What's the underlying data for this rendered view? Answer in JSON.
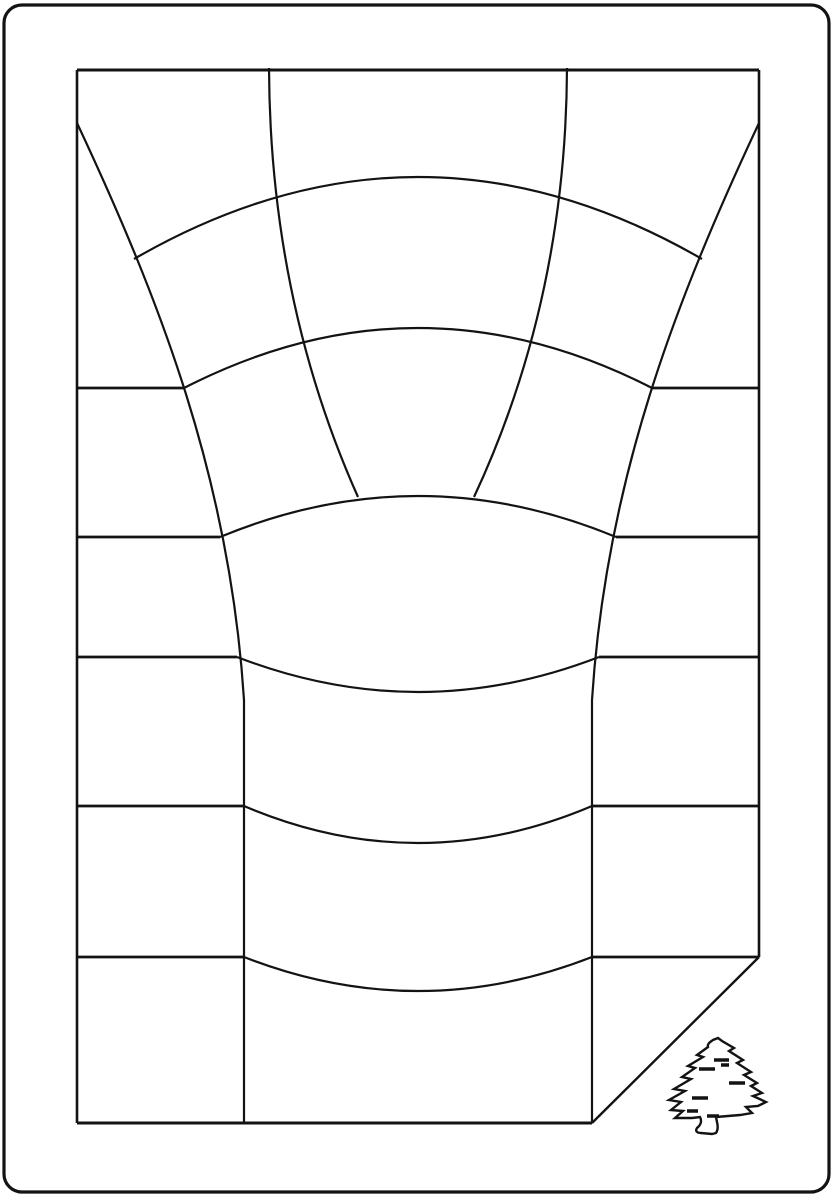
{
  "canvas": {
    "width": 834,
    "height": 1200,
    "background_color": "#ffffff"
  },
  "drawing": {
    "stroke_color": "#131313",
    "default_stroke_width": 2.2,
    "elements": [
      {
        "name": "outer-border",
        "type": "rect",
        "x": 4,
        "y": 5,
        "width": 825,
        "height": 1187,
        "radius": 18,
        "stroke_width": 3.2
      },
      {
        "name": "sheet-top-edge",
        "d": "M77,70 H759",
        "stroke_width": 3
      },
      {
        "name": "sheet-left-edge",
        "d": "M77,70 V1123",
        "stroke_width": 2.6
      },
      {
        "name": "sheet-right-edge",
        "d": "M759,70 V957",
        "stroke_width": 2.6
      },
      {
        "name": "sheet-bottom-edge",
        "d": "M77,1123 H592",
        "stroke_width": 3
      },
      {
        "name": "folded-corner-diagonal",
        "d": "M759,957 L592,1123",
        "stroke_width": 2.4
      },
      {
        "name": "warp-line-left-outer",
        "d": "M77,123 C160,300 230,480 244,700 L244,1123",
        "stroke_width": 2.2
      },
      {
        "name": "warp-line-right-outer",
        "d": "M759,123 C676,300 606,480 592,700 L592,1123",
        "stroke_width": 2.2
      },
      {
        "name": "warp-line-left-inner",
        "d": "M269,68 Q270,300 358,497",
        "stroke_width": 2.2
      },
      {
        "name": "warp-line-right-inner",
        "d": "M567,68 Q566,300 474,497",
        "stroke_width": 2.2
      },
      {
        "name": "ring-arc-1",
        "d": "M134,259 Q418,95 702,259",
        "stroke_width": 2.2
      },
      {
        "name": "ring-arc-2",
        "d": "M184,388 Q418,268 652,388",
        "stroke_width": 2.2
      },
      {
        "name": "ring-arc-3",
        "d": "M220,537 Q418,455 616,537",
        "stroke_width": 2.2
      },
      {
        "name": "ring-arc-4",
        "d": "M237,657 Q418,727 599,657",
        "stroke_width": 2.2
      },
      {
        "name": "ring-arc-5",
        "d": "M244,806 Q418,880 592,806",
        "stroke_width": 2.2
      },
      {
        "name": "ring-arc-6",
        "d": "M244,957 Q418,1025 592,957",
        "stroke_width": 2.2
      },
      {
        "name": "row-line-1",
        "d": "M77,388 H184 M652,388 H759",
        "stroke_width": 2.8
      },
      {
        "name": "row-line-2",
        "d": "M77,537 H220 M616,537 H759",
        "stroke_width": 2.8
      },
      {
        "name": "row-line-3",
        "d": "M77,657 H237 M599,657 H759",
        "stroke_width": 2.8
      },
      {
        "name": "row-line-4",
        "d": "M77,806 H244 M592,806 H759",
        "stroke_width": 2.8
      },
      {
        "name": "row-line-5",
        "d": "M77,957 H244 M592,957 H759",
        "stroke_width": 2.8
      },
      {
        "name": "pine-tree-icon",
        "d": "M713,1040 C710,1042 707,1044 708,1047 L697,1055 L703,1057 L688,1066 L695,1068 L682,1077 L691,1079 L674,1089 L685,1091 L669,1100 L681,1102 L671,1110 L683,1111 L675,1118 L692,1118 L700,1117 C702,1121 701,1125 697,1128 C695,1131 697,1133 701,1133 L712,1134 L716,1133 C718,1130 718,1126 717,1122 L716,1117 L728,1116 L740,1115 L752,1113 L746,1107 L758,1106 L766,1102 L753,1096 L762,1093 L751,1086 L757,1083 L744,1075 L751,1072 L737,1063 L743,1060 L729,1051 L734,1048 L722,1041 L718,1038 Z",
        "stroke_width": 2.4
      },
      {
        "name": "pine-tree-branch-strokes",
        "d": "M714,1060 H729 M699,1069 H715 M721,1065 H729 M692,1098 H708 M729,1083 H745 M687,1111 H698 M707,1116 H719",
        "stroke_width": 3.6
      }
    ]
  }
}
